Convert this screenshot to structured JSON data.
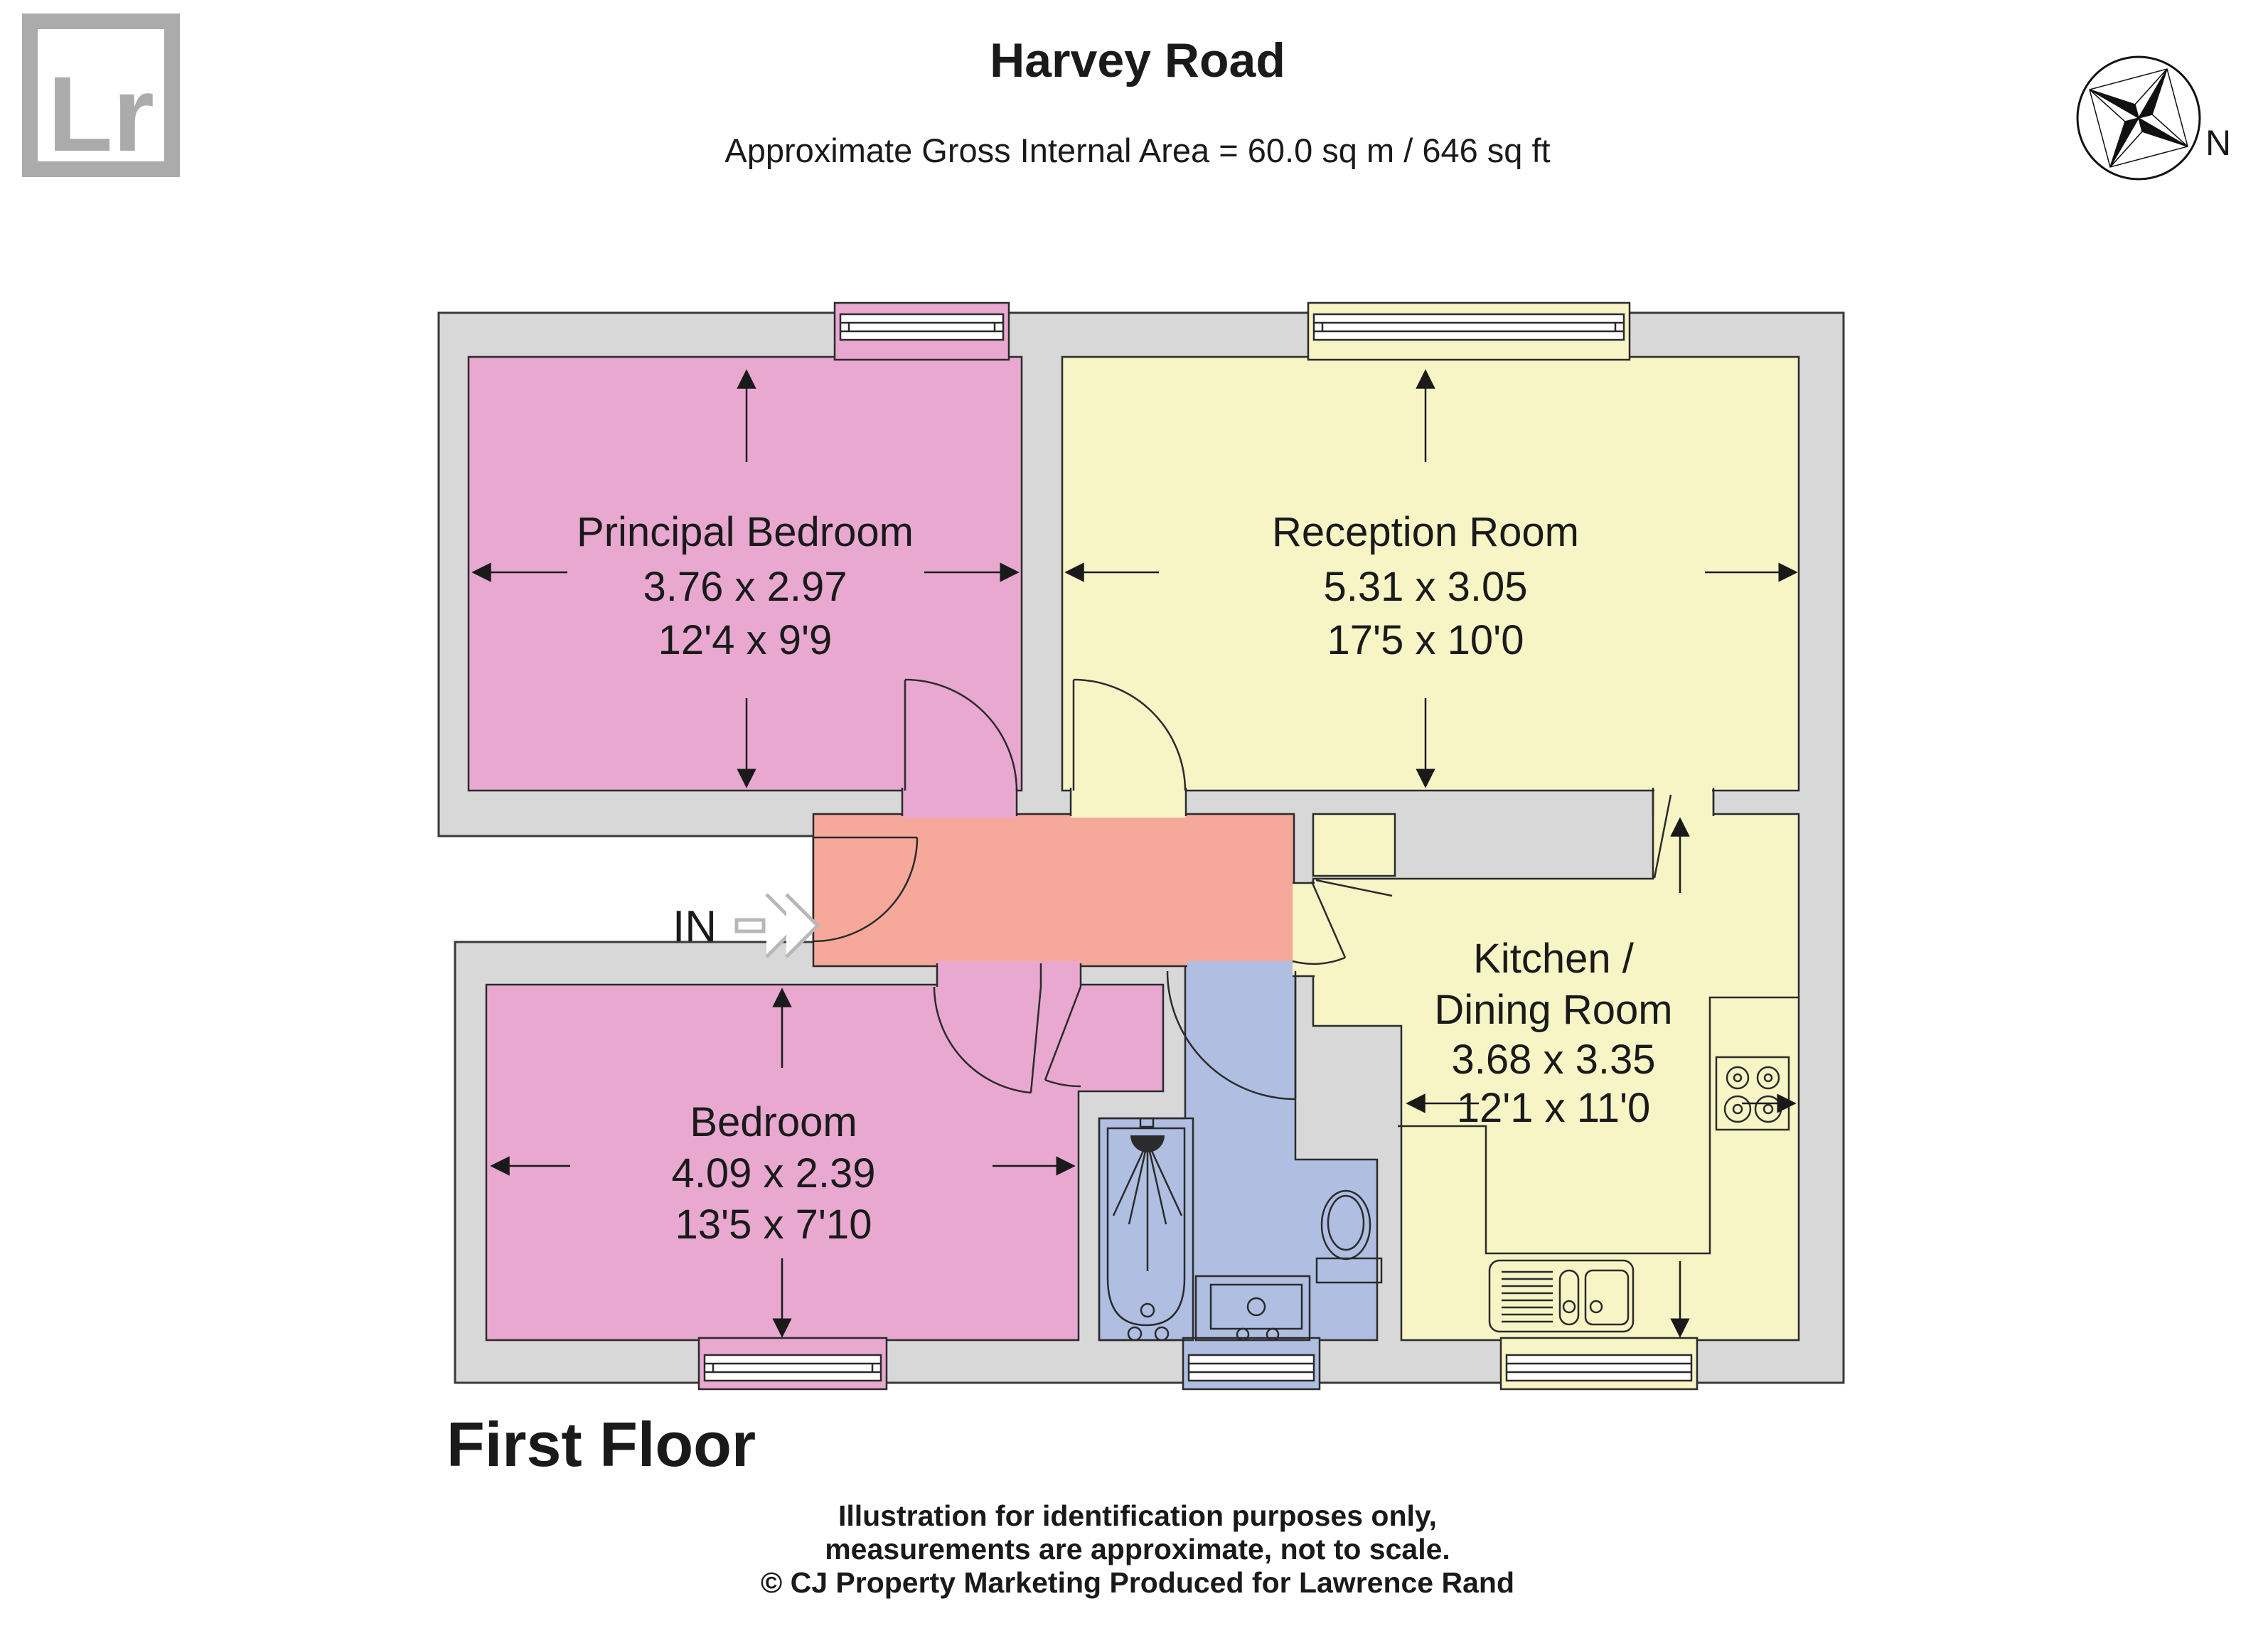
{
  "header": {
    "logo_text": "Lr",
    "title": "Harvey Road",
    "subtitle": "Approximate Gross Internal Area = 60.0 sq m / 646 sq ft",
    "compass_label": "N"
  },
  "rooms": [
    {
      "name": "Principal Bedroom",
      "metric": "3.76 x 2.97",
      "imperial": "12'4 x 9'9"
    },
    {
      "name": "Reception Room",
      "metric": "5.31 x 3.05",
      "imperial": "17'5 x 10'0"
    },
    {
      "name": "Bedroom",
      "metric": "4.09 x 2.39",
      "imperial": "13'5 x 7'10"
    },
    {
      "name_line1": "Kitchen /",
      "name_line2": "Dining Room",
      "metric": "3.68 x 3.35",
      "imperial": "12'1 x 11'0"
    }
  ],
  "labels": {
    "entrance": "IN",
    "floor": "First Floor"
  },
  "footer": {
    "line1": "Illustration for identification purposes only,",
    "line2": "measurements are approximate, not to scale.",
    "line3": "© CJ Property Marketing  Produced for Lawrence Rand"
  },
  "colors": {
    "pink": "#e8a8d0",
    "yellow": "#f7f4c6",
    "salmon": "#f6a99b",
    "blue": "#afbee1",
    "wall": "#d8d8d8",
    "logo_gray": "#ababab",
    "text": "#1a1a1a"
  }
}
